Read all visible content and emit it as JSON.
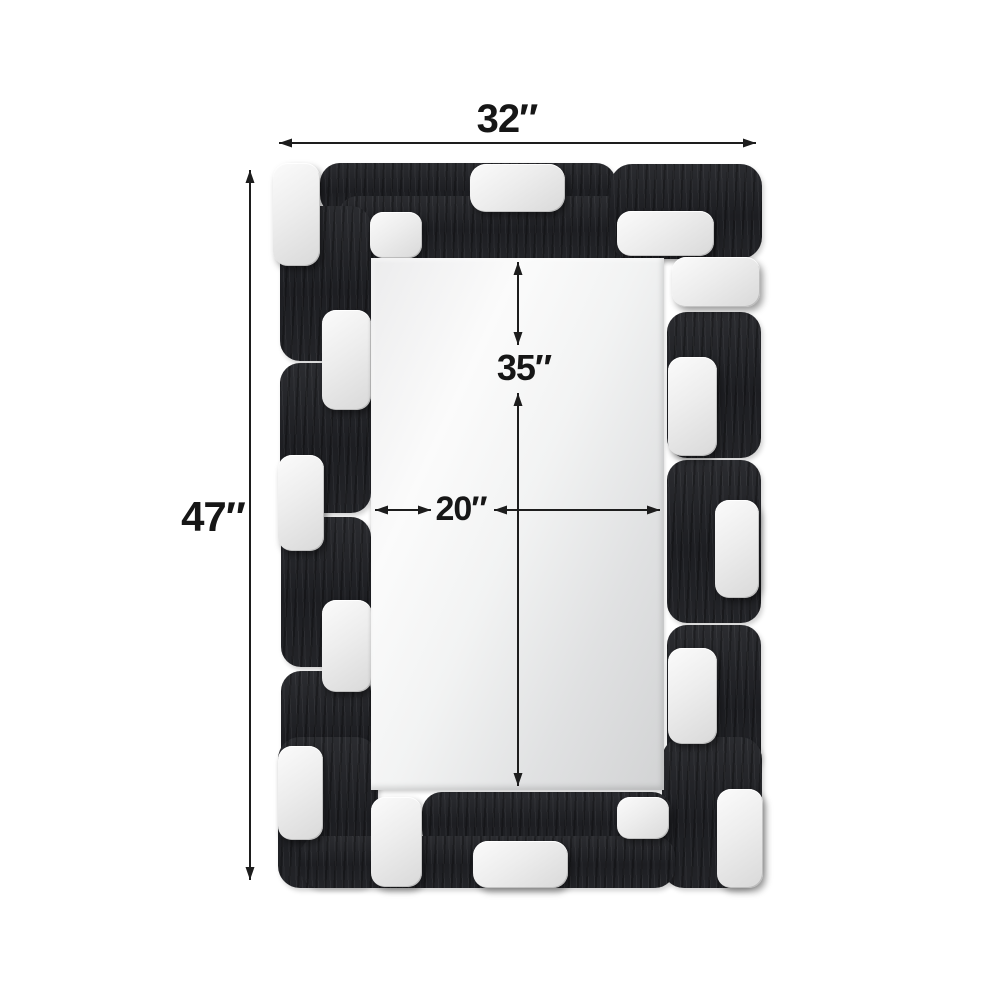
{
  "diagram": {
    "type": "product-dimension-diagram",
    "subject": "Rectangular wall mirror with geometric black wood and silver block mosaic frame",
    "labels": {
      "overall_width": "32″",
      "overall_height": "47″",
      "mirror_height": "35″",
      "mirror_width": "20″"
    },
    "colors": {
      "background": "#ffffff",
      "frame_black": "#222327",
      "frame_silver": "#e9e9e9",
      "mirror_glass": "#e7e8e9",
      "dimension_line": "#1d1d1d",
      "label_text": "#161616"
    }
  }
}
